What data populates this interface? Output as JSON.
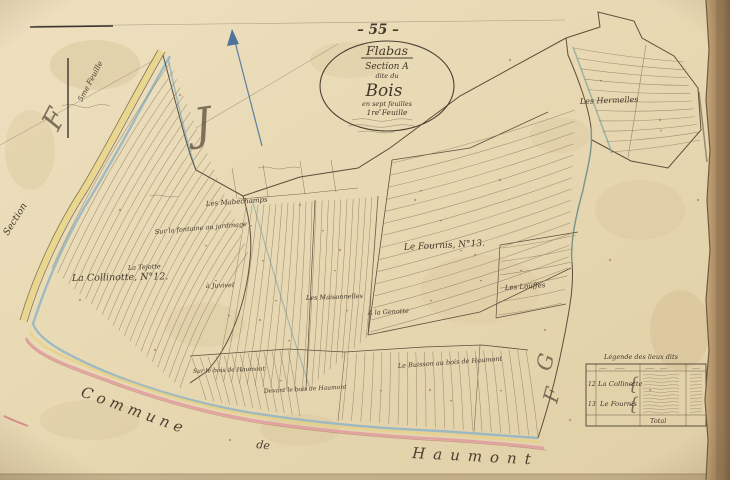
{
  "sheet": {
    "number": "– 55 –",
    "title": {
      "commune": "Flabas",
      "section": "Section A",
      "dite": "dite du",
      "name": "Bois",
      "feuilles": "en sept feuilles",
      "feuille": "1re Feuille"
    }
  },
  "margins": {
    "adjacent_sheet": "5me Feuille",
    "flourish_left": "F",
    "flourish_center": "J",
    "flourish_right_1": "G",
    "flourish_right_2": "F",
    "section_word": "Section",
    "commune_word": "Commune",
    "de_word": "de",
    "haumont_word": "Haumont"
  },
  "labels": [
    "La Collinotte, N°12.",
    "Le Fournis, N°13.",
    "Les Hermelles",
    "Les Mabéchamps",
    "Sur la fontaine au jardinage",
    "La Tejotte",
    "à Juvivel",
    "Les Maisonnelles",
    "A la Genotte",
    "Les Louffes",
    "Sur le bois de Haumont",
    "Devant le bois de Haumont",
    "Le Buisson au bois de Haumont"
  ],
  "legend": {
    "title": "Légende des lieux dits",
    "rows": [
      {
        "no": "12",
        "name": "La Collinotte"
      },
      {
        "no": "13",
        "name": "Le Fournis"
      }
    ],
    "total_label": "Total"
  },
  "colors": {
    "paper": "#e7d8b4",
    "ink": "#4c4134",
    "stream_blue": "#8fb4c5",
    "road_yellow": "#e8d07c",
    "boundary_pink": "#e09aa0",
    "teal": "#7fa89e"
  }
}
